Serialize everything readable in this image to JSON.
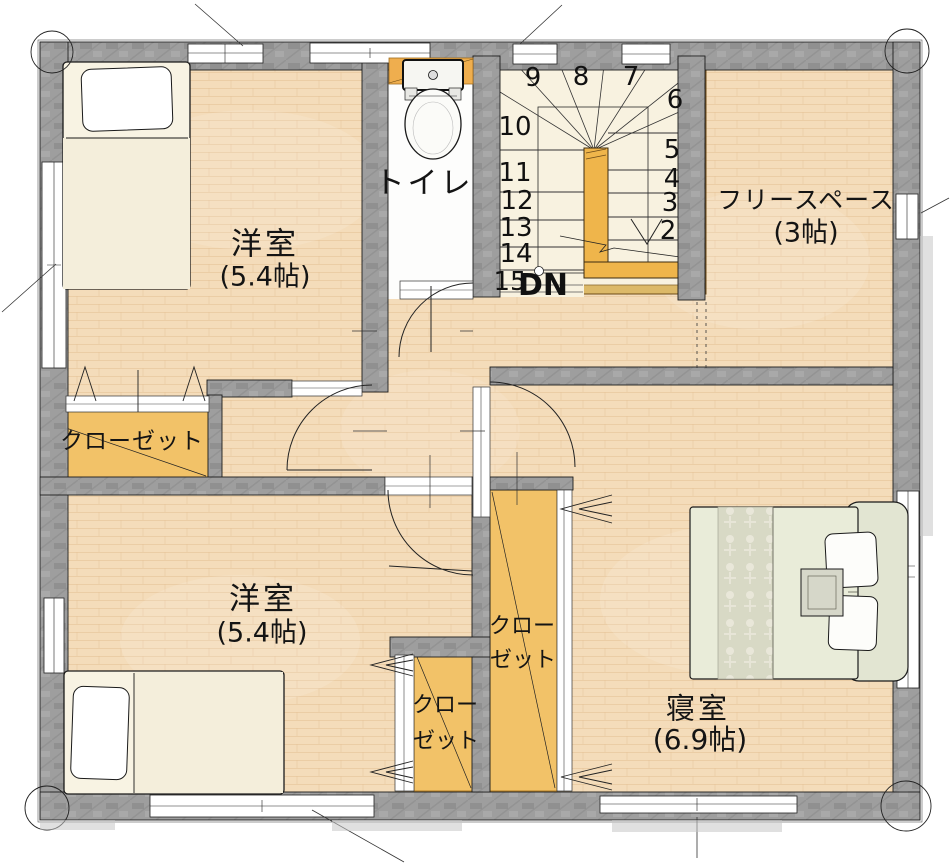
{
  "colors": {
    "floor": "#f4dcba",
    "wall_gray": "#9e9e9e",
    "closet_orange": "#f2c268",
    "stair_floor": "#f8f2e0",
    "railing_orange": "#efb54b",
    "counter_orange": "#efae4e",
    "bed_sage": "#e9ecd9",
    "outline": "#1c1c1c"
  },
  "rooms": {
    "western_top": {
      "name": "洋室",
      "size": "(5.4帖)"
    },
    "western_bottom": {
      "name": "洋室",
      "size": "(5.4帖)"
    },
    "bedroom": {
      "name": "寝室",
      "size": "(6.9帖)"
    },
    "free_space": {
      "name": "フリースペース",
      "size": "(3帖)"
    },
    "toilet": {
      "name": "トイレ"
    }
  },
  "closets": {
    "left": {
      "label": "クローゼット"
    },
    "bottom_left": {
      "line1": "クロー",
      "line2": "ゼット"
    },
    "bottom_right": {
      "line1": "クロー",
      "line2": "ゼット"
    }
  },
  "stairs": {
    "numbers": [
      "9",
      "8",
      "7",
      "6",
      "5",
      "4",
      "3",
      "2",
      "10",
      "11",
      "12",
      "13",
      "14",
      "15"
    ],
    "down_label": "DN"
  }
}
